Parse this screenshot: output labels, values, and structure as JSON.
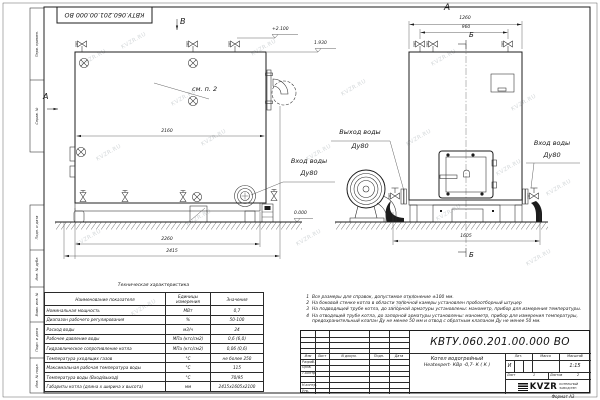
{
  "watermark": "KVZR.RU",
  "stamp": {
    "doc_number_rotated": "КВТУ.060.201.00.000  ВО"
  },
  "margin_stamps": [
    "Перв. примен.",
    "Справ. №",
    "Подп. и дата",
    "Инв. № дубл.",
    "Взам. инв. №",
    "Подп. и дата",
    "Инв. № подл."
  ],
  "side_view": {
    "section_a": "А",
    "section_b": "В",
    "see_note": "см. п. 2",
    "elev_top": "+2.100",
    "elev_mid": "1.930",
    "elev_zero": "0.000",
    "dim_inner": "2160",
    "dim_base": "2260",
    "dim_full": "2415",
    "inlet_l1": "Вход воды",
    "inlet_l2": "Ду80"
  },
  "front_view": {
    "section_a": "А",
    "section_b": "Б",
    "dim_top": "1260",
    "dim_valves": "960",
    "dim_width": "1605",
    "outlet_l1": "Выход воды",
    "outlet_l2": "Ду80",
    "inlet_l1": "Вход воды",
    "inlet_l2": "Ду80"
  },
  "notes": [
    {
      "num": "1",
      "text": "Все размеры для справок, допустимое отклонение ±100 мм."
    },
    {
      "num": "2",
      "text": "На боковой стенке котла в области топочной камеры установлен пробоотборный штуцер"
    },
    {
      "num": "3",
      "text": "На подводящей трубе котла, до запорной арматуры установлены: манометр, прибор для измерения температуры."
    },
    {
      "num": "4",
      "text": "На отводящей трубе котла, до запорной арматуры установлены: манометр, прибор для измерения температуры, предохранительный клапан Ду не менее 50 мм и отвод с обратным клапаном Ду не менее 50 мм."
    }
  ],
  "spec_table": {
    "title": "Техническая характеристика",
    "col_name": "Наименование показателя",
    "col_units": "Единицы\nизмерения",
    "col_value": "Значения",
    "rows": [
      {
        "name": "Номинальная мощность",
        "units": "МВт",
        "value": "0,7"
      },
      {
        "name": "Диапазон рабочего регулирования",
        "units": "%",
        "value": "50-100"
      },
      {
        "name": "Расход воды",
        "units": "м3/ч",
        "value": "24"
      },
      {
        "name": "Рабочее давление воды",
        "units": "МПа (кгс/см2)",
        "value": "0,6 (6,0)"
      },
      {
        "name": "Гидравлическое сопротивление котла",
        "units": "МПа (кгс/см2)",
        "value": "0,06 (0,6)"
      },
      {
        "name": "Температура уходящих газов",
        "units": "°С",
        "value": "не более 250"
      },
      {
        "name": "Максимальная рабочая температура воды",
        "units": "°С",
        "value": "115"
      },
      {
        "name": "Температура воды (Вход/выход)",
        "units": "°С",
        "value": "70/95"
      },
      {
        "name": "Габариты котла (длина х ширина х высота)",
        "units": "мм",
        "value": "2415х1605х2100"
      }
    ]
  },
  "title_block": {
    "doc_number": "КВТУ.060.201.00.000  ВО",
    "product_l1": "Котел водогрейный",
    "product_l2": "Heatexpert- КВр -0,7- К ( К )",
    "col_izm": "Изм",
    "col_list": "Лист",
    "col_doc": "N докум.",
    "col_podp": "Подп.",
    "col_data": "Дата",
    "row_razrab": "Разраб.",
    "row_prov": "Пров.",
    "row_tkontr": "Т.контр.",
    "row_nkontr": "Н.контр.",
    "row_utv": "Утв.",
    "lit_label": "Лит.",
    "lit_value": "И",
    "mass_label": "Масса",
    "scale_label": "Масштаб",
    "scale_value": "1:15",
    "sheet_label": "Лист",
    "sheet_value": "1",
    "sheets_label": "Листов",
    "sheets_value": "2",
    "logo_text": "KVZR",
    "company_l1": "КОТЕЛЬНЫЙ",
    "company_l2": "ЗАВОД РЭП",
    "format_label": "Формат  А3"
  }
}
